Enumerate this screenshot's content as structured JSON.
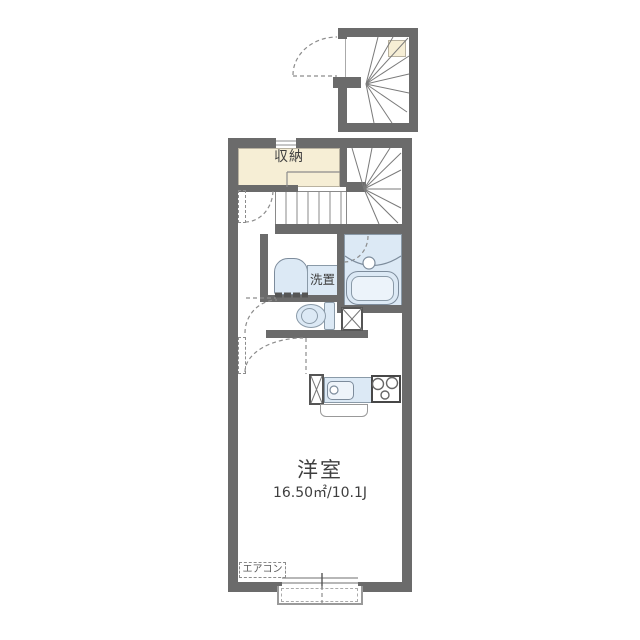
{
  "plan": {
    "labels": {
      "closet": "収納",
      "laundry": "洗置",
      "room_name": "洋室",
      "room_size": "16.50㎡/10.1J",
      "aircon": "エアコン"
    },
    "colors": {
      "wall": "#6b6b6b",
      "closet_fill": "#f6eed5",
      "fixture_fill": "#dce9f5",
      "fixture_line": "#7d8c9c",
      "thin_line": "#999999",
      "text": "#3f3f3f"
    }
  }
}
